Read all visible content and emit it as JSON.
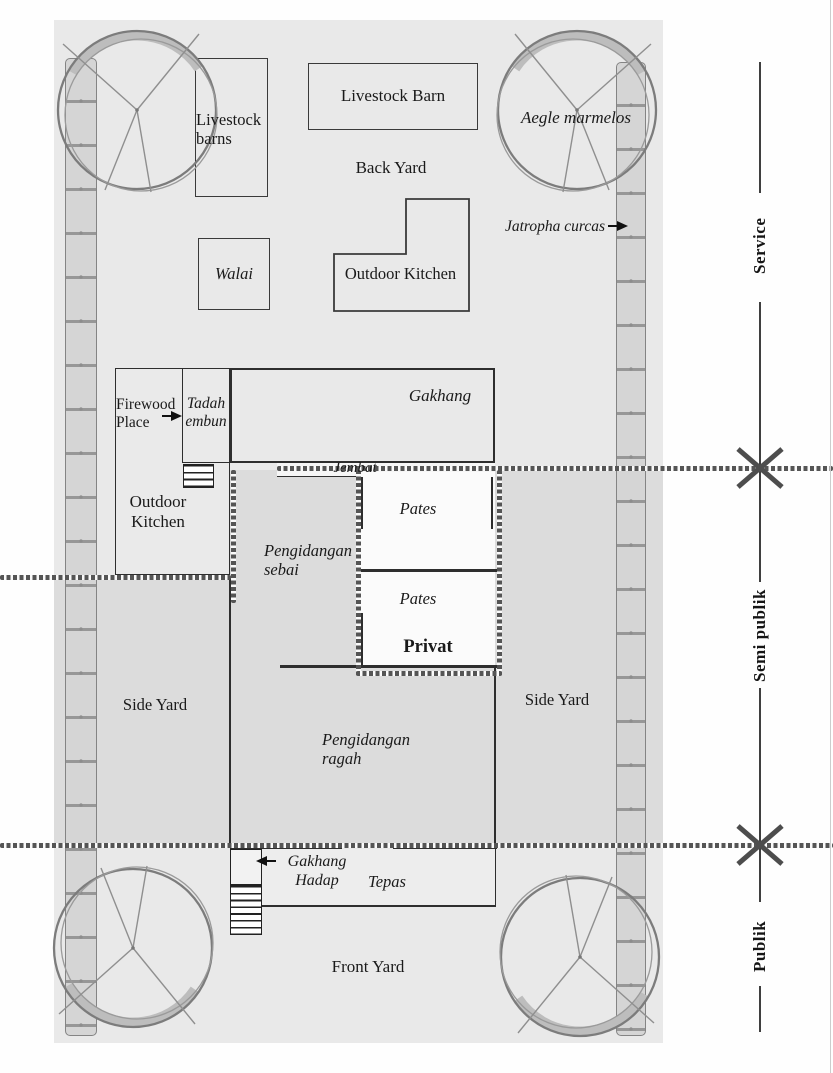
{
  "labels": {
    "livestock_barns_left": "Livestock barns",
    "livestock_barn_top": "Livestock Barn",
    "back_yard": "Back Yard",
    "walai": "Walai",
    "outdoor_kitchen_top": "Outdoor Kitchen",
    "aegle_marmelos": "Aegle marmelos",
    "jatropha_curcas": "Jatropha curcas",
    "firewood_place": "Firewood Place",
    "tadah_embun": "Tadah embun",
    "outdoor_kitchen_left": "Outdoor Kitchen",
    "gakhang": "Gakhang",
    "jembat": "Jembat",
    "pates_upper": "Pates",
    "pates_lower": "Pates",
    "privat": "Privat",
    "pengidangan_sebai": "Pengidangan sebai",
    "side_yard_left": "Side Yard",
    "side_yard_right": "Side Yard",
    "pengidangan_ragah": "Pengidangan ragah",
    "gakhang_hadap": "Gakhang Hadap",
    "tepas": "Tepas",
    "front_yard": "Front Yard"
  },
  "zones": {
    "service": "Service",
    "semi_public": "Semi publik",
    "public": "Publik"
  },
  "colors": {
    "site_fill": "#e9e9e9",
    "semi_public_band": "#dcdcdc",
    "wall": "#2e2e2e",
    "room_white": "#fbfbfb"
  }
}
